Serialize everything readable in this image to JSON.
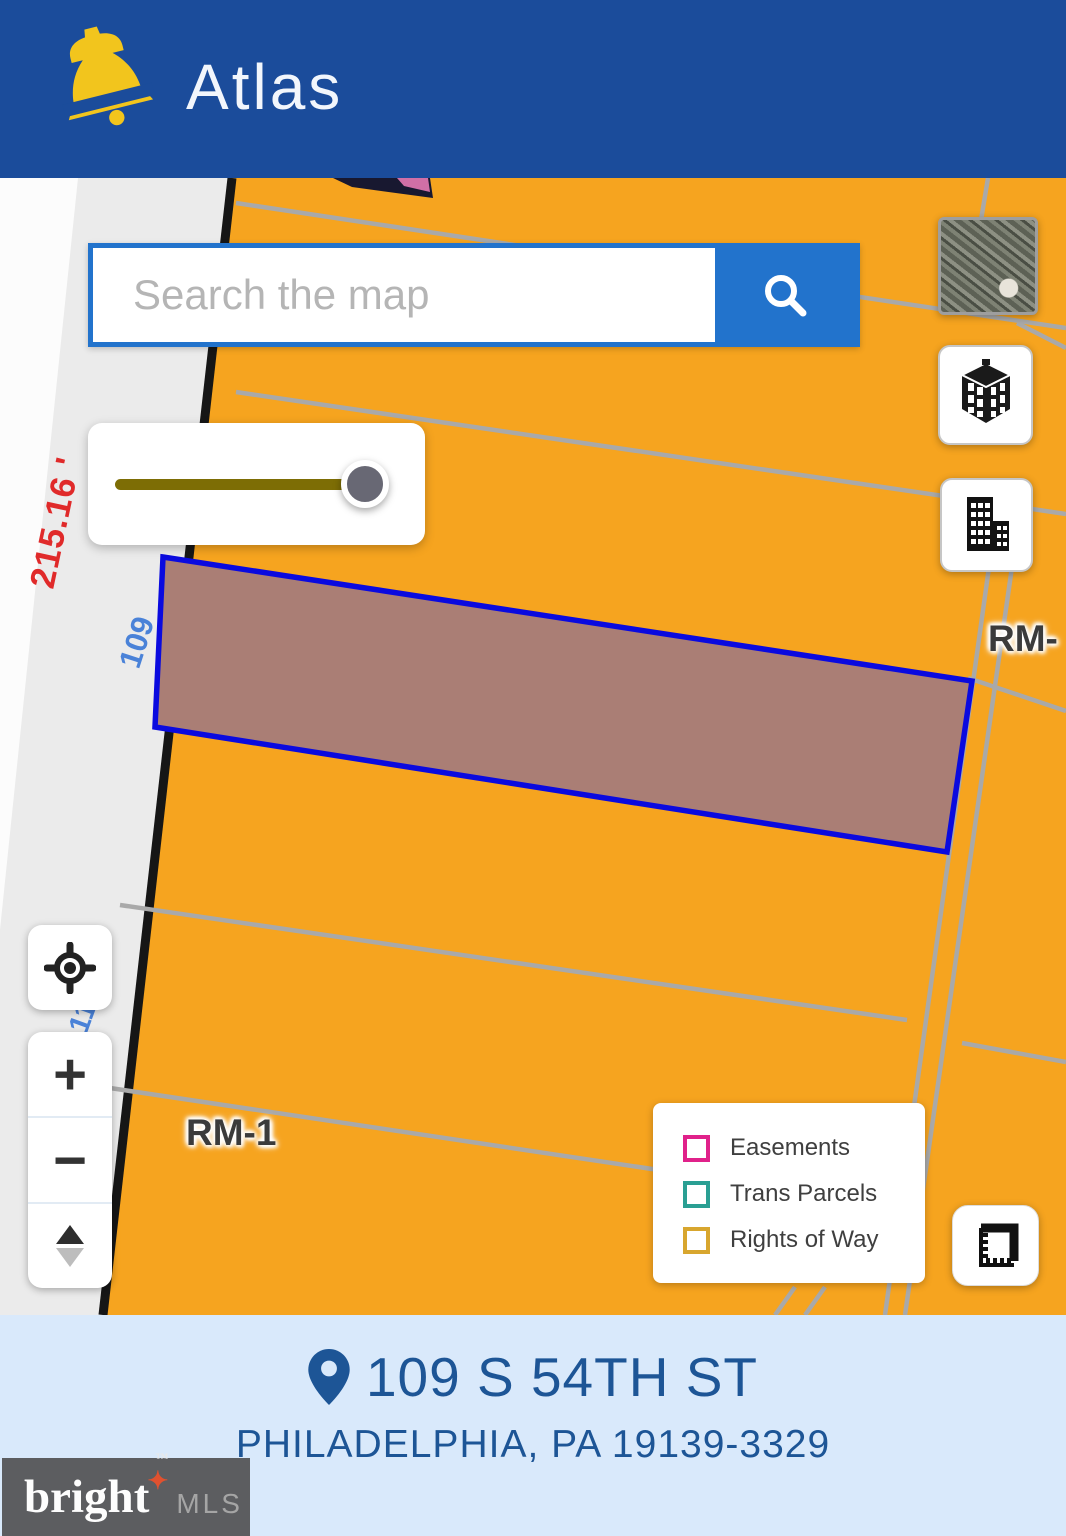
{
  "app": {
    "title": "Atlas"
  },
  "search": {
    "placeholder": "Search the map"
  },
  "controls": {
    "zoom_in": "+",
    "zoom_out": "−",
    "slider_value_percent": 97
  },
  "map": {
    "zoning_label_left": "RM-1",
    "zoning_label_right": "RM-",
    "dim_street": "215.16 '",
    "dim_parcel_front": "109",
    "dim_parcel_partial": "11"
  },
  "legend": {
    "items": [
      {
        "label": "Easements",
        "color": "#e0218a"
      },
      {
        "label": "Trans Parcels",
        "color": "#2a9f93"
      },
      {
        "label": "Rights of Way",
        "color": "#d8a62e"
      }
    ]
  },
  "footer": {
    "address_line1": "109 S 54TH ST",
    "address_line2": "PHILADELPHIA, PA 19139-3329"
  },
  "watermark": {
    "brand": "bright",
    "star": "✦",
    "tm": "™",
    "suffix": "MLS"
  },
  "colors": {
    "header_bg": "#1b4c9b",
    "accent_blue": "#2273cc",
    "map_orange": "#f6a41f",
    "parcel_line_gray": "#a9a9a9",
    "selected_parcel_fill": "#aa7e75",
    "selected_parcel_stroke": "#0a0adf",
    "dim_red": "#e02a2a",
    "dim_blue": "#4a82d8",
    "slider_track": "#7d6d05",
    "footer_bg": "#d9e9fb",
    "footer_text": "#1d5596"
  }
}
